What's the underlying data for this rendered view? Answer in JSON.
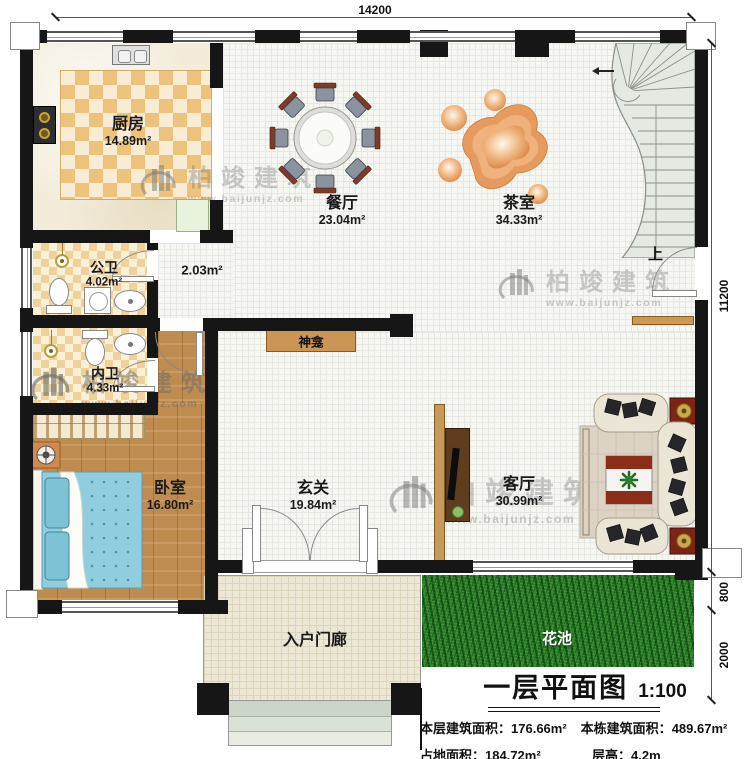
{
  "plan": {
    "watermark": {
      "brand": "柏竣建筑",
      "url": "www.baijunjz.com"
    },
    "dimensions": {
      "top_width": "14200",
      "right_total": "11200",
      "right_flower_top": "800",
      "right_flower_height": "2000"
    },
    "rooms": {
      "kitchen": {
        "name": "厨房",
        "area": "14.89m²"
      },
      "dining": {
        "name": "餐厅",
        "area": "23.04m²"
      },
      "tea": {
        "name": "茶室",
        "area": "34.33m²"
      },
      "public_bath": {
        "name": "公卫",
        "area": "4.02m²"
      },
      "inner_bath": {
        "name": "内卫",
        "area": "4.33m²"
      },
      "corridor": {
        "area": "2.03m²"
      },
      "bedroom": {
        "name": "卧室",
        "area": "16.80m²"
      },
      "foyer": {
        "name": "玄关",
        "area": "19.84m²"
      },
      "living": {
        "name": "客厅",
        "area": "30.99m²"
      },
      "porch": {
        "name": "入户门廊"
      },
      "flower_bed": {
        "name": "花池"
      }
    },
    "features": {
      "shrine": "神龛",
      "stairs_up": "上"
    },
    "title_block": {
      "title": "一层平面图",
      "scale": "1:100",
      "floor_area_label": "本层建筑面积：",
      "floor_area_value": "176.66m²",
      "building_area_label": "本栋建筑面积：",
      "building_area_value": "489.67m²",
      "footprint_label": "占地面积：",
      "footprint_value": "184.72m²",
      "storey_height_label": "层高：",
      "storey_height_value": "4.2m"
    },
    "colors": {
      "wall": "#161616",
      "wood_floor": "#bf8c50",
      "grass": "#2b7a2b",
      "bed": "#8fcede",
      "stairs": "#e4eae1",
      "checker_tile": "#ecc27c",
      "accent_maroon": "#7e2517",
      "shelf_wood": "#cb9553"
    }
  }
}
